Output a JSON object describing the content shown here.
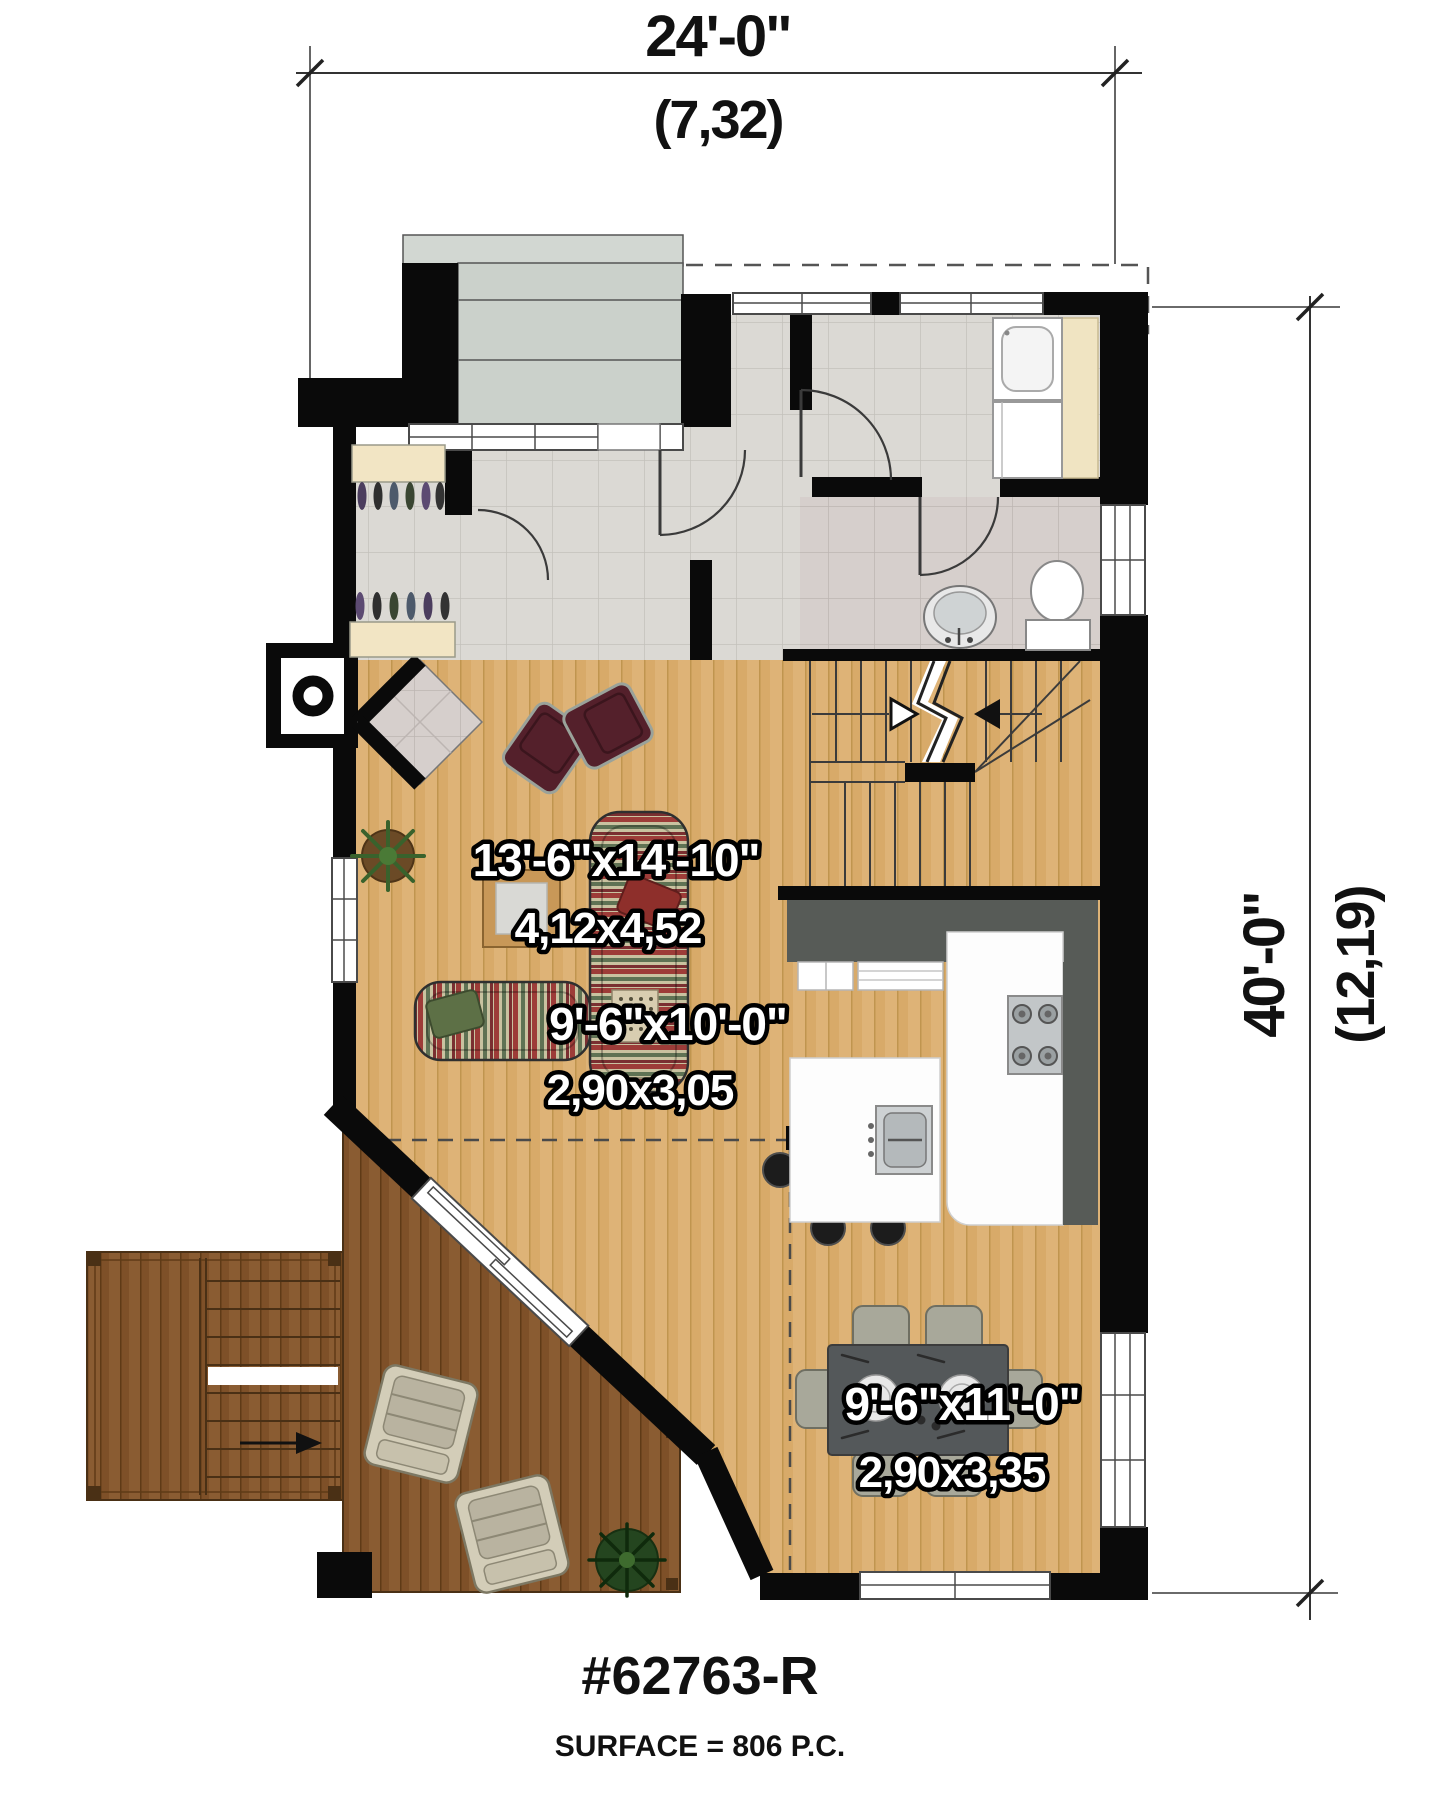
{
  "title": {
    "plan_number": "#62763-R",
    "surface": "SURFACE = 806 P.C."
  },
  "dimensions": {
    "top": {
      "imperial": "24'-0\"",
      "metric": "(7,32)"
    },
    "right": {
      "imperial": "40'-0\"",
      "metric": "(12,19)"
    }
  },
  "rooms": {
    "living": {
      "imperial": "13'-6\"x14'-10\"",
      "metric": "4,12x4,52"
    },
    "kitchen": {
      "imperial": "9'-6\"x10'-0\"",
      "metric": "2,90x3,05"
    },
    "dining": {
      "imperial": "9'-6\"x11'-0\"",
      "metric": "2,90x3,35"
    }
  },
  "colors": {
    "wall": "#0a0a0a",
    "wood_light": "#deb377",
    "wood_dark": "#8a5c32",
    "tile_hall": "#dbd9d4",
    "tile_bath": "#d6cfcc",
    "porch_concrete": "#cbd1cb",
    "counter_dark": "#575b57",
    "shelf_cream": "#f2e5c4",
    "label_fill": "#ffffff",
    "label_stroke": "#000000"
  }
}
